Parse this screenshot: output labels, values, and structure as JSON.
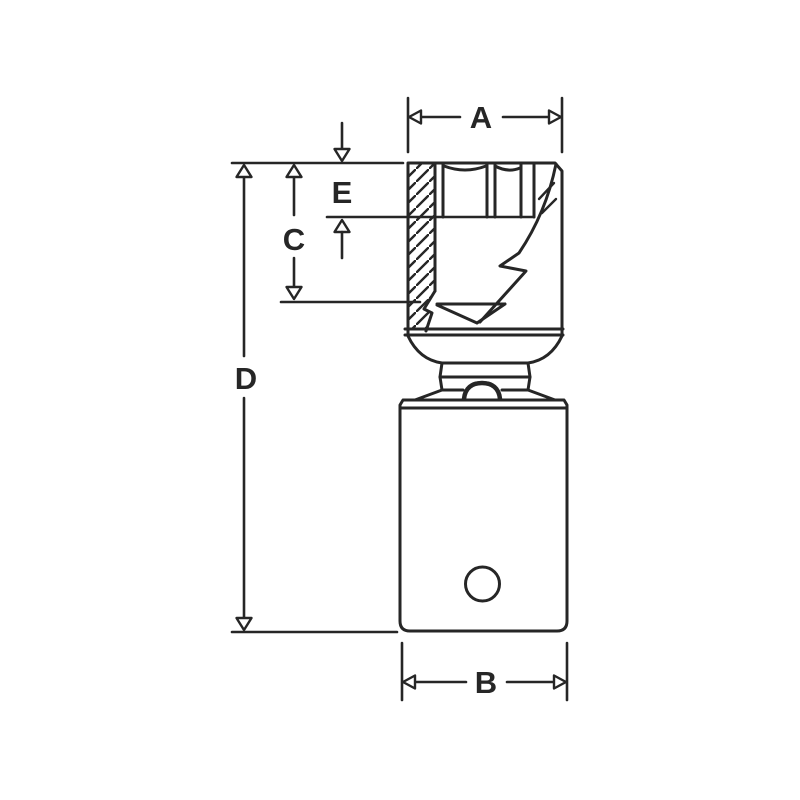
{
  "canvas": {
    "width": 800,
    "height": 800,
    "background_color": "#ffffff",
    "line_color": "#262626"
  },
  "drawing": {
    "kind": "technical line drawing",
    "subject": "socket / drive adapter shown in partial cross-section with dimension callouts"
  },
  "labels": {
    "a": "A",
    "b": "B",
    "c": "C",
    "d": "D",
    "e": "E"
  },
  "dimensions": [
    {
      "label": "A",
      "orientation": "horizontal",
      "location": "top, across the socket head width"
    },
    {
      "label": "B",
      "orientation": "horizontal",
      "location": "bottom, across the drive body width"
    },
    {
      "label": "C",
      "orientation": "vertical",
      "location": "left, from head top down to inner cavity bottom"
    },
    {
      "label": "D",
      "orientation": "vertical",
      "location": "far left, overall length of the tool"
    },
    {
      "label": "E",
      "orientation": "vertical",
      "location": "upper left, from head top to hex recess bottom"
    }
  ]
}
